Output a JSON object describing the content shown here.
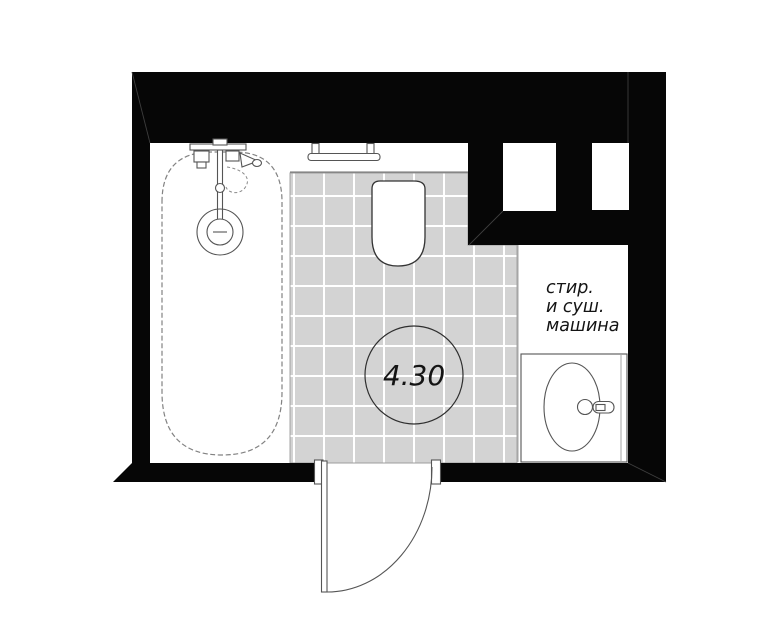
{
  "plan": {
    "area_circle": {
      "value": "4.30"
    },
    "washer_label": {
      "line1": "стир.",
      "line2": "и суш.",
      "line3": "машина"
    },
    "fixtures": [
      "bathtub",
      "shower-mixer",
      "tub-drain",
      "wall-shelf",
      "toilet",
      "wall-niche-left",
      "wall-niche-right",
      "washer-dryer-zone",
      "sink-counter",
      "sink-basin",
      "sink-faucet",
      "entry-door-swing"
    ],
    "colors": {
      "wall": "#060606",
      "tile_fill": "#d3d3d3",
      "tile_grout": "#ffffff",
      "line": "#555555",
      "line_light": "#a6a6a6",
      "text": "#141414",
      "background": "#ffffff"
    }
  }
}
